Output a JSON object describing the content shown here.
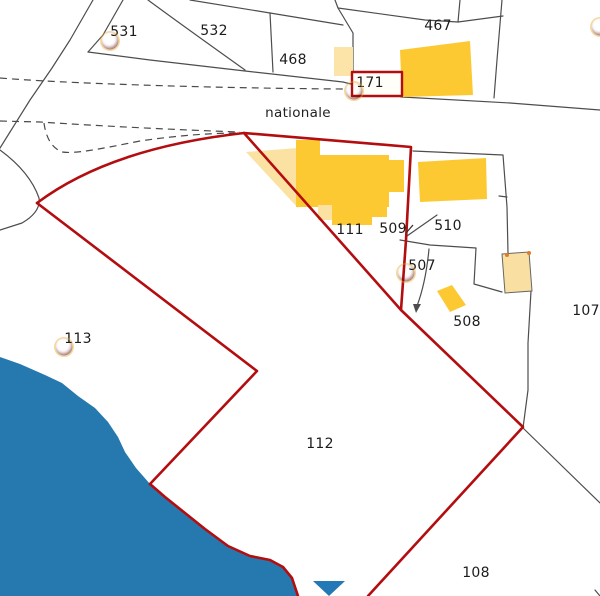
{
  "map": {
    "road_label": "nationale",
    "colors": {
      "selection_red": "#b30d10",
      "parcel_line": "#4d4d4d",
      "building_dark": "#fdc933",
      "building_light": "#fbe2a2",
      "water_blue": "#2679ae",
      "marker_orange": "#e05206",
      "triangle_blue": "#2279b5",
      "label_text": "#1c1c1c"
    },
    "parcel_labels": [
      {
        "id": "531",
        "text": "531",
        "x": 124,
        "y": 32
      },
      {
        "id": "532",
        "text": "532",
        "x": 214,
        "y": 31
      },
      {
        "id": "467",
        "text": "467",
        "x": 438,
        "y": 26
      },
      {
        "id": "468",
        "text": "468",
        "x": 293,
        "y": 60
      },
      {
        "id": "171",
        "text": "171",
        "x": 370,
        "y": 83
      },
      {
        "id": "111",
        "text": "111",
        "x": 350,
        "y": 230
      },
      {
        "id": "509",
        "text": "509",
        "x": 393,
        "y": 229
      },
      {
        "id": "510",
        "text": "510",
        "x": 448,
        "y": 226
      },
      {
        "id": "507",
        "text": "507",
        "x": 422,
        "y": 266
      },
      {
        "id": "508",
        "text": "508",
        "x": 467,
        "y": 322
      },
      {
        "id": "107",
        "text": "107",
        "x": 586,
        "y": 311
      },
      {
        "id": "113",
        "text": "113",
        "x": 78,
        "y": 339
      },
      {
        "id": "112",
        "text": "112",
        "x": 320,
        "y": 444
      },
      {
        "id": "108",
        "text": "108",
        "x": 476,
        "y": 573
      }
    ],
    "markers": [
      {
        "id": "531",
        "x": 110,
        "y": 41
      },
      {
        "id": "171",
        "x": 354,
        "y": 91
      },
      {
        "id": "507",
        "x": 406,
        "y": 273
      },
      {
        "id": "113",
        "x": 64,
        "y": 347
      },
      {
        "id": "top-right",
        "x": 600,
        "y": 27
      }
    ],
    "pointer_triangle": {
      "x1": 313,
      "y1": 581,
      "x2": 345,
      "y2": 581,
      "x3": 329,
      "y3": 596
    }
  }
}
